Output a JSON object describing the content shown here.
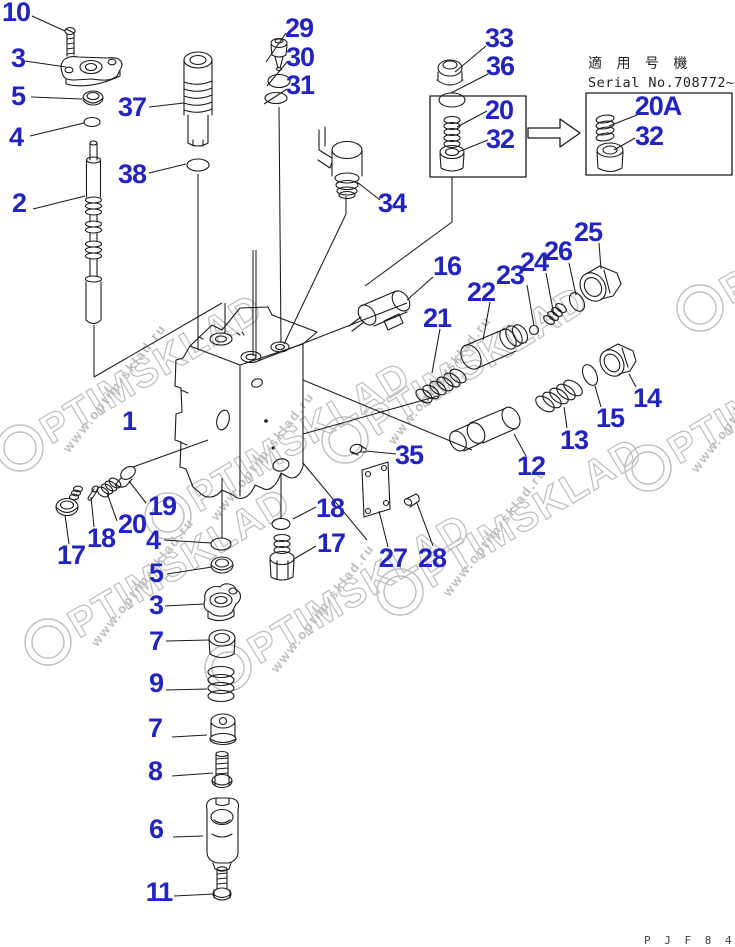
{
  "colors": {
    "callout_blue": "#2323bf",
    "line": "#1a1a1a",
    "watermark_gray": "#bdbdbd",
    "background": "#ffffff"
  },
  "serial_box": {
    "label_jp": "適 用 号 機",
    "serial_label": "Serial No.708772~"
  },
  "footer": {
    "drawing_code": "P J F 8 4 3 4"
  },
  "watermark": {
    "brand": "OPTIMSKLAD",
    "url": "www.optim-sklad.ru",
    "positions": [
      {
        "x": 20,
        "y": 448
      },
      {
        "x": 48,
        "y": 642
      },
      {
        "x": 228,
        "y": 668
      },
      {
        "x": 168,
        "y": 516
      },
      {
        "x": 345,
        "y": 440
      },
      {
        "x": 400,
        "y": 592
      },
      {
        "x": 648,
        "y": 468
      },
      {
        "x": 700,
        "y": 308
      }
    ]
  },
  "diagram": {
    "callouts": [
      {
        "label": "10",
        "x": 16,
        "y": 12
      },
      {
        "label": "3",
        "x": 18,
        "y": 58
      },
      {
        "label": "5",
        "x": 18,
        "y": 96
      },
      {
        "label": "4",
        "x": 16,
        "y": 137
      },
      {
        "label": "37",
        "x": 132,
        "y": 107
      },
      {
        "label": "38",
        "x": 132,
        "y": 174
      },
      {
        "label": "2",
        "x": 19,
        "y": 203
      },
      {
        "label": "29",
        "x": 299,
        "y": 28
      },
      {
        "label": "30",
        "x": 300,
        "y": 57
      },
      {
        "label": "31",
        "x": 300,
        "y": 85
      },
      {
        "label": "34",
        "x": 392,
        "y": 203
      },
      {
        "label": "33",
        "x": 499,
        "y": 38
      },
      {
        "label": "36",
        "x": 500,
        "y": 66
      },
      {
        "label": "20",
        "x": 499,
        "y": 110
      },
      {
        "label": "32",
        "x": 500,
        "y": 139
      },
      {
        "label": "20A",
        "x": 658,
        "y": 106
      },
      {
        "label": "32",
        "x": 649,
        "y": 136
      },
      {
        "label": "25",
        "x": 588,
        "y": 232
      },
      {
        "label": "26",
        "x": 558,
        "y": 251
      },
      {
        "label": "24",
        "x": 534,
        "y": 262
      },
      {
        "label": "23",
        "x": 510,
        "y": 275
      },
      {
        "label": "16",
        "x": 447,
        "y": 266
      },
      {
        "label": "22",
        "x": 481,
        "y": 292
      },
      {
        "label": "21",
        "x": 437,
        "y": 318
      },
      {
        "label": "14",
        "x": 647,
        "y": 398
      },
      {
        "label": "15",
        "x": 610,
        "y": 418
      },
      {
        "label": "13",
        "x": 574,
        "y": 440
      },
      {
        "label": "12",
        "x": 531,
        "y": 466
      },
      {
        "label": "1",
        "x": 129,
        "y": 421
      },
      {
        "label": "35",
        "x": 409,
        "y": 455
      },
      {
        "label": "19",
        "x": 162,
        "y": 506
      },
      {
        "label": "20",
        "x": 132,
        "y": 524
      },
      {
        "label": "18",
        "x": 101,
        "y": 538
      },
      {
        "label": "17",
        "x": 71,
        "y": 555
      },
      {
        "label": "4",
        "x": 153,
        "y": 540
      },
      {
        "label": "5",
        "x": 156,
        "y": 573
      },
      {
        "label": "3",
        "x": 156,
        "y": 605
      },
      {
        "label": "7",
        "x": 156,
        "y": 641
      },
      {
        "label": "9",
        "x": 156,
        "y": 683
      },
      {
        "label": "7",
        "x": 155,
        "y": 728
      },
      {
        "label": "8",
        "x": 155,
        "y": 771
      },
      {
        "label": "6",
        "x": 156,
        "y": 829
      },
      {
        "label": "11",
        "x": 159,
        "y": 892
      },
      {
        "label": "18",
        "x": 330,
        "y": 508
      },
      {
        "label": "17",
        "x": 331,
        "y": 543
      },
      {
        "label": "27",
        "x": 393,
        "y": 558
      },
      {
        "label": "28",
        "x": 432,
        "y": 558
      }
    ],
    "leaders": [
      [
        32,
        16,
        65,
        31
      ],
      [
        25,
        61,
        66,
        67
      ],
      [
        31,
        97,
        82,
        99
      ],
      [
        30,
        136,
        84,
        123
      ],
      [
        149,
        107,
        184,
        103
      ],
      [
        149,
        173,
        186,
        164
      ],
      [
        33,
        209,
        85,
        196
      ],
      [
        286,
        33,
        266,
        62
      ],
      [
        287,
        62,
        267,
        86
      ],
      [
        287,
        89,
        264,
        104
      ],
      [
        380,
        200,
        357,
        182
      ],
      [
        486,
        46,
        455,
        72
      ],
      [
        488,
        74,
        451,
        93
      ],
      [
        487,
        111,
        457,
        127
      ],
      [
        488,
        140,
        458,
        152
      ],
      [
        637,
        115,
        609,
        126
      ],
      [
        635,
        138,
        614,
        150
      ],
      [
        599,
        243,
        601,
        269
      ],
      [
        569,
        263,
        576,
        295
      ],
      [
        546,
        273,
        554,
        315
      ],
      [
        527,
        285,
        534,
        326
      ],
      [
        433,
        277,
        407,
        300
      ],
      [
        490,
        302,
        483,
        340
      ],
      [
        440,
        329,
        432,
        373
      ],
      [
        636,
        387,
        629,
        374
      ],
      [
        601,
        407,
        595,
        386
      ],
      [
        567,
        428,
        564,
        407
      ],
      [
        526,
        456,
        514,
        434
      ],
      [
        396,
        454,
        366,
        451
      ],
      [
        146,
        503,
        129,
        481
      ],
      [
        117,
        521,
        107,
        493
      ],
      [
        94,
        527,
        91,
        497
      ],
      [
        69,
        544,
        65,
        515
      ],
      [
        164,
        540,
        211,
        543
      ],
      [
        167,
        574,
        212,
        567
      ],
      [
        165,
        606,
        204,
        604
      ],
      [
        166,
        641,
        209,
        640
      ],
      [
        166,
        690,
        207,
        689
      ],
      [
        172,
        737,
        207,
        735
      ],
      [
        172,
        776,
        213,
        773
      ],
      [
        173,
        837,
        203,
        836
      ],
      [
        174,
        896,
        214,
        894
      ],
      [
        316,
        507,
        293,
        519
      ],
      [
        316,
        546,
        294,
        559
      ],
      [
        388,
        547,
        379,
        511
      ],
      [
        433,
        546,
        417,
        503
      ],
      [
        133,
        467,
        208,
        440
      ]
    ],
    "axis_lines": [
      [
        94,
        325,
        94,
        377
      ],
      [
        94,
        377,
        222,
        303
      ],
      [
        225,
        303,
        225,
        334
      ],
      [
        198,
        174,
        198,
        350
      ],
      [
        253,
        250,
        253,
        356
      ],
      [
        256,
        250,
        256,
        356
      ],
      [
        279,
        107,
        281,
        343
      ],
      [
        346,
        196,
        346,
        214
      ],
      [
        346,
        214,
        284,
        344
      ],
      [
        452,
        177,
        452,
        222
      ],
      [
        452,
        222,
        365,
        286
      ],
      [
        258,
        361,
        407,
        303
      ],
      [
        303,
        434,
        438,
        396
      ],
      [
        303,
        380,
        472,
        450
      ],
      [
        303,
        463,
        367,
        540
      ],
      [
        222,
        478,
        222,
        538
      ],
      [
        281,
        474,
        281,
        518
      ]
    ]
  }
}
